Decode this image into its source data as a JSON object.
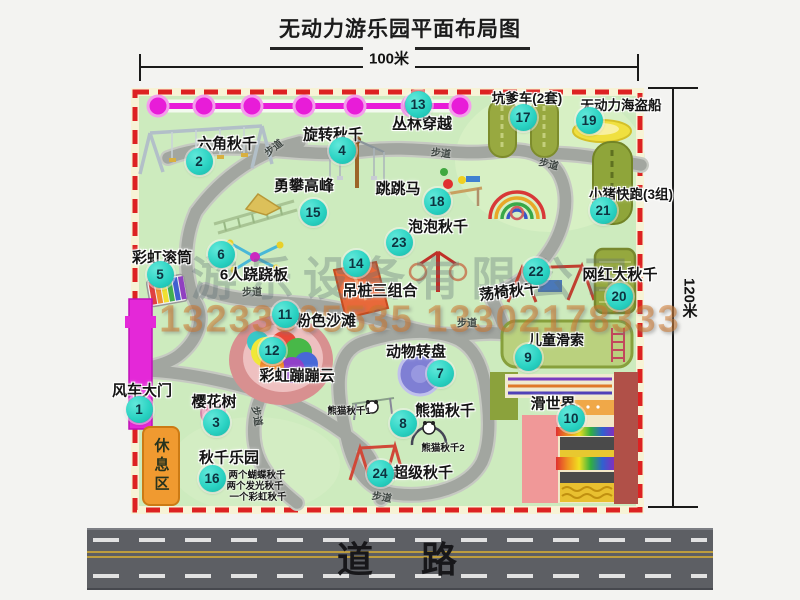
{
  "title": "无动力游乐园平面布局图",
  "dimensions": {
    "width": "100米",
    "height": "120米"
  },
  "road": {
    "label": "道　路"
  },
  "watermark": {
    "company": "游乐设备有限公司",
    "phone": "13233805535 13302178333"
  },
  "labels": {
    "path": "步道",
    "rest_area": "休息区"
  },
  "attractions": {
    "a1": {
      "num": "1",
      "name": "风车大门"
    },
    "a2": {
      "num": "2",
      "name": "六角秋千"
    },
    "a3": {
      "num": "3",
      "name": "樱花树"
    },
    "a4": {
      "num": "4",
      "name": "旋转秋千"
    },
    "a5": {
      "num": "5",
      "name": "彩虹滚筒"
    },
    "a6": {
      "num": "6",
      "name": "6人跷跷板"
    },
    "a7": {
      "num": "7",
      "name": "动物转盘"
    },
    "a8": {
      "num": "8",
      "name": "熊猫秋千"
    },
    "a9": {
      "num": "9",
      "name": "儿童滑索"
    },
    "a10": {
      "num": "10",
      "name": "滑世界"
    },
    "a11": {
      "num": "11",
      "name": "粉色沙滩"
    },
    "a12": {
      "num": "12",
      "name": "彩虹蹦蹦云"
    },
    "a13": {
      "num": "13",
      "name": "丛林穿越"
    },
    "a14": {
      "num": "14",
      "name": "吊桩三组合"
    },
    "a15": {
      "num": "15",
      "name": "勇攀高峰"
    },
    "a16": {
      "num": "16",
      "name": "秋千乐园"
    },
    "a17": {
      "num": "17",
      "name": "坑爹车(2套)"
    },
    "a18": {
      "num": "18",
      "name": "跳跳马"
    },
    "a19": {
      "num": "19",
      "name": "无动力海盗船"
    },
    "a20": {
      "num": "20",
      "name": "网红大秋千"
    },
    "a21": {
      "num": "21",
      "name": "小猪快跑(3组)"
    },
    "a22": {
      "num": "22",
      "name": "荡椅秋千"
    },
    "a23": {
      "num": "23",
      "name": "泡泡秋千"
    },
    "a24": {
      "num": "24",
      "name": "超级秋千"
    }
  },
  "annotations": {
    "swing_park_items": [
      "两个蝴蝶秋千",
      "两个发光秋千",
      "一个彩虹秋千"
    ],
    "panda_swing_1": "熊猫秋千1",
    "panda_swing_2": "熊猫秋千2"
  },
  "colors": {
    "park_fill": "#cdebbe",
    "border_red": "#dd2222",
    "path_gray": "#a2a6a0",
    "badge_teal": "#2bd3c3",
    "gate_magenta": "#e428d8",
    "rest_orange": "#f09a30",
    "road_gray": "#5d5f64",
    "zipline_pink": "#e81cd8"
  }
}
